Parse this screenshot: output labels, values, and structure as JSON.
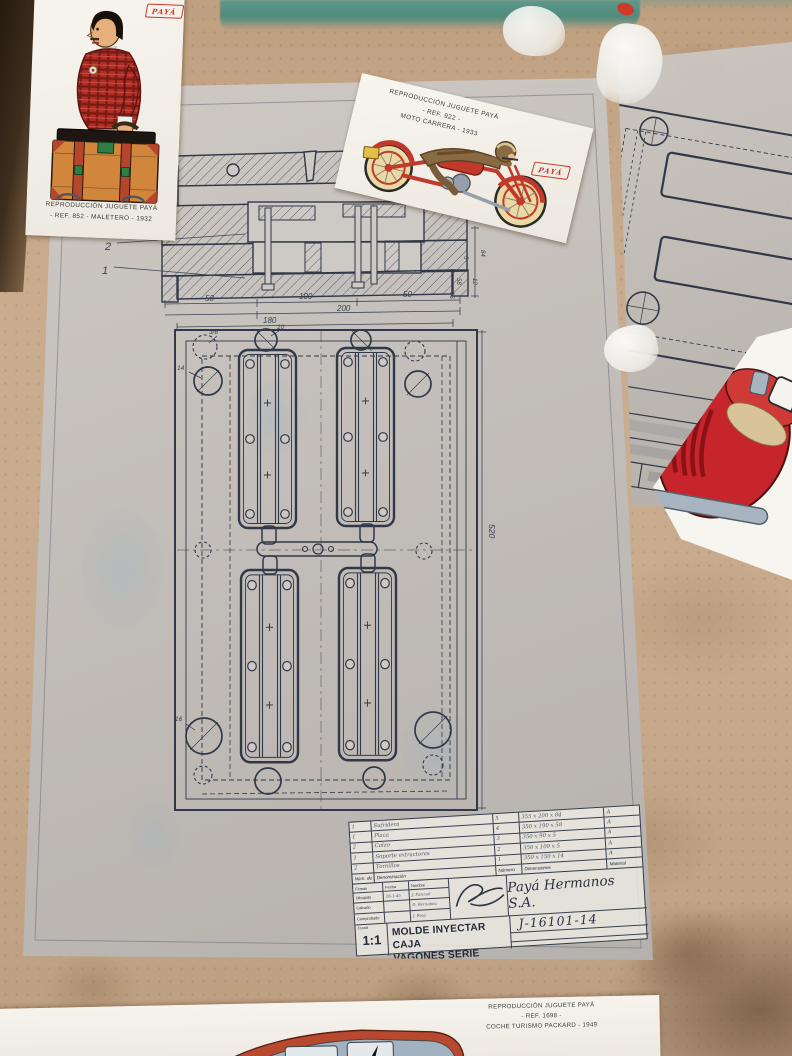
{
  "colors": {
    "accent_red": "#c5392b",
    "ink": "#313847",
    "sheet_gray": "#c9c5c0",
    "desk_tan": "#c7a98c",
    "mat_teal": "#4f8a7c"
  },
  "cards": {
    "maletero": {
      "brand": "PAYÁ",
      "line1": "REPRODUCCIÓN JUGUETE PAYÁ",
      "line2": "- REF. 852 -  MALETERO - 1932"
    },
    "moto": {
      "brand": "PAYÁ",
      "line1": "REPRODUCCIÓN JUGUETE PAYÁ",
      "line2": "- REF. 922 -",
      "line3": "MOTO CARRERA - 1933"
    },
    "packard": {
      "line1": "REPRODUCCIÓN JUGUETE PAYÁ",
      "line2": "- REF. 1698 -",
      "line3": "COCHE TURISMO PACKARD - 1949"
    }
  },
  "main_drawing": {
    "callouts": {
      "c2": "2",
      "c1": "1"
    },
    "section_dims": {
      "d1": "50",
      "d2": "100",
      "d3": "200",
      "d4": "50",
      "d5": "180"
    },
    "side_dims": {
      "s1": "84",
      "s2": "5",
      "s3": "58",
      "s4": "12",
      "s5": "16"
    },
    "plan": {
      "height_dim": "520",
      "h1": "3/8\"",
      "h2": "10",
      "h3": "14",
      "h4": "16"
    },
    "title_block": {
      "company": "Payá Hermanos S.A.",
      "drawing_number": "J-16101-14",
      "scale_label": "Escala",
      "scale_value": "1:1",
      "title1": "MOLDE INYECTAR CAJA",
      "title2": "VAGONES SERIE 16101",
      "parts": {
        "col_qty": "Núm. de p.",
        "col_name": "Denominación",
        "col_num": "Número",
        "col_dims": "Dimensiones",
        "col_mat": "Material",
        "rows": [
          {
            "qty": "1",
            "name": "Sufridera",
            "num": "5",
            "dims": "355 x 200 x 84",
            "mat": "A"
          },
          {
            "qty": "1",
            "name": "Placa",
            "num": "4",
            "dims": "350 x 190 x 58",
            "mat": "A"
          },
          {
            "qty": "2",
            "name": "Calzo",
            "num": "3",
            "dims": "350 x 90 x 5",
            "mat": "A"
          },
          {
            "qty": "1",
            "name": "Soporte extractores",
            "num": "2",
            "dims": "350 x 100 x 5",
            "mat": "A"
          },
          {
            "qty": "2",
            "name": "Tornillos",
            "num": "1",
            "dims": "350 x 150 x 14",
            "mat": "A"
          }
        ]
      },
      "sign": {
        "col_firmas": "Firmas",
        "col_fecha": "Fecha",
        "col_nombre": "Nombre",
        "rows": [
          {
            "label": "Dibujado",
            "fecha": "26-1-45",
            "nombre": "J. Pascual"
          },
          {
            "label": "Calcado",
            "fecha": "",
            "nombre": "D. Bernabeu"
          },
          {
            "label": "Comprobado",
            "fecha": "",
            "nombre": "J. Roig"
          }
        ]
      }
    }
  },
  "side_drawing": {
    "scale": "1:1"
  }
}
